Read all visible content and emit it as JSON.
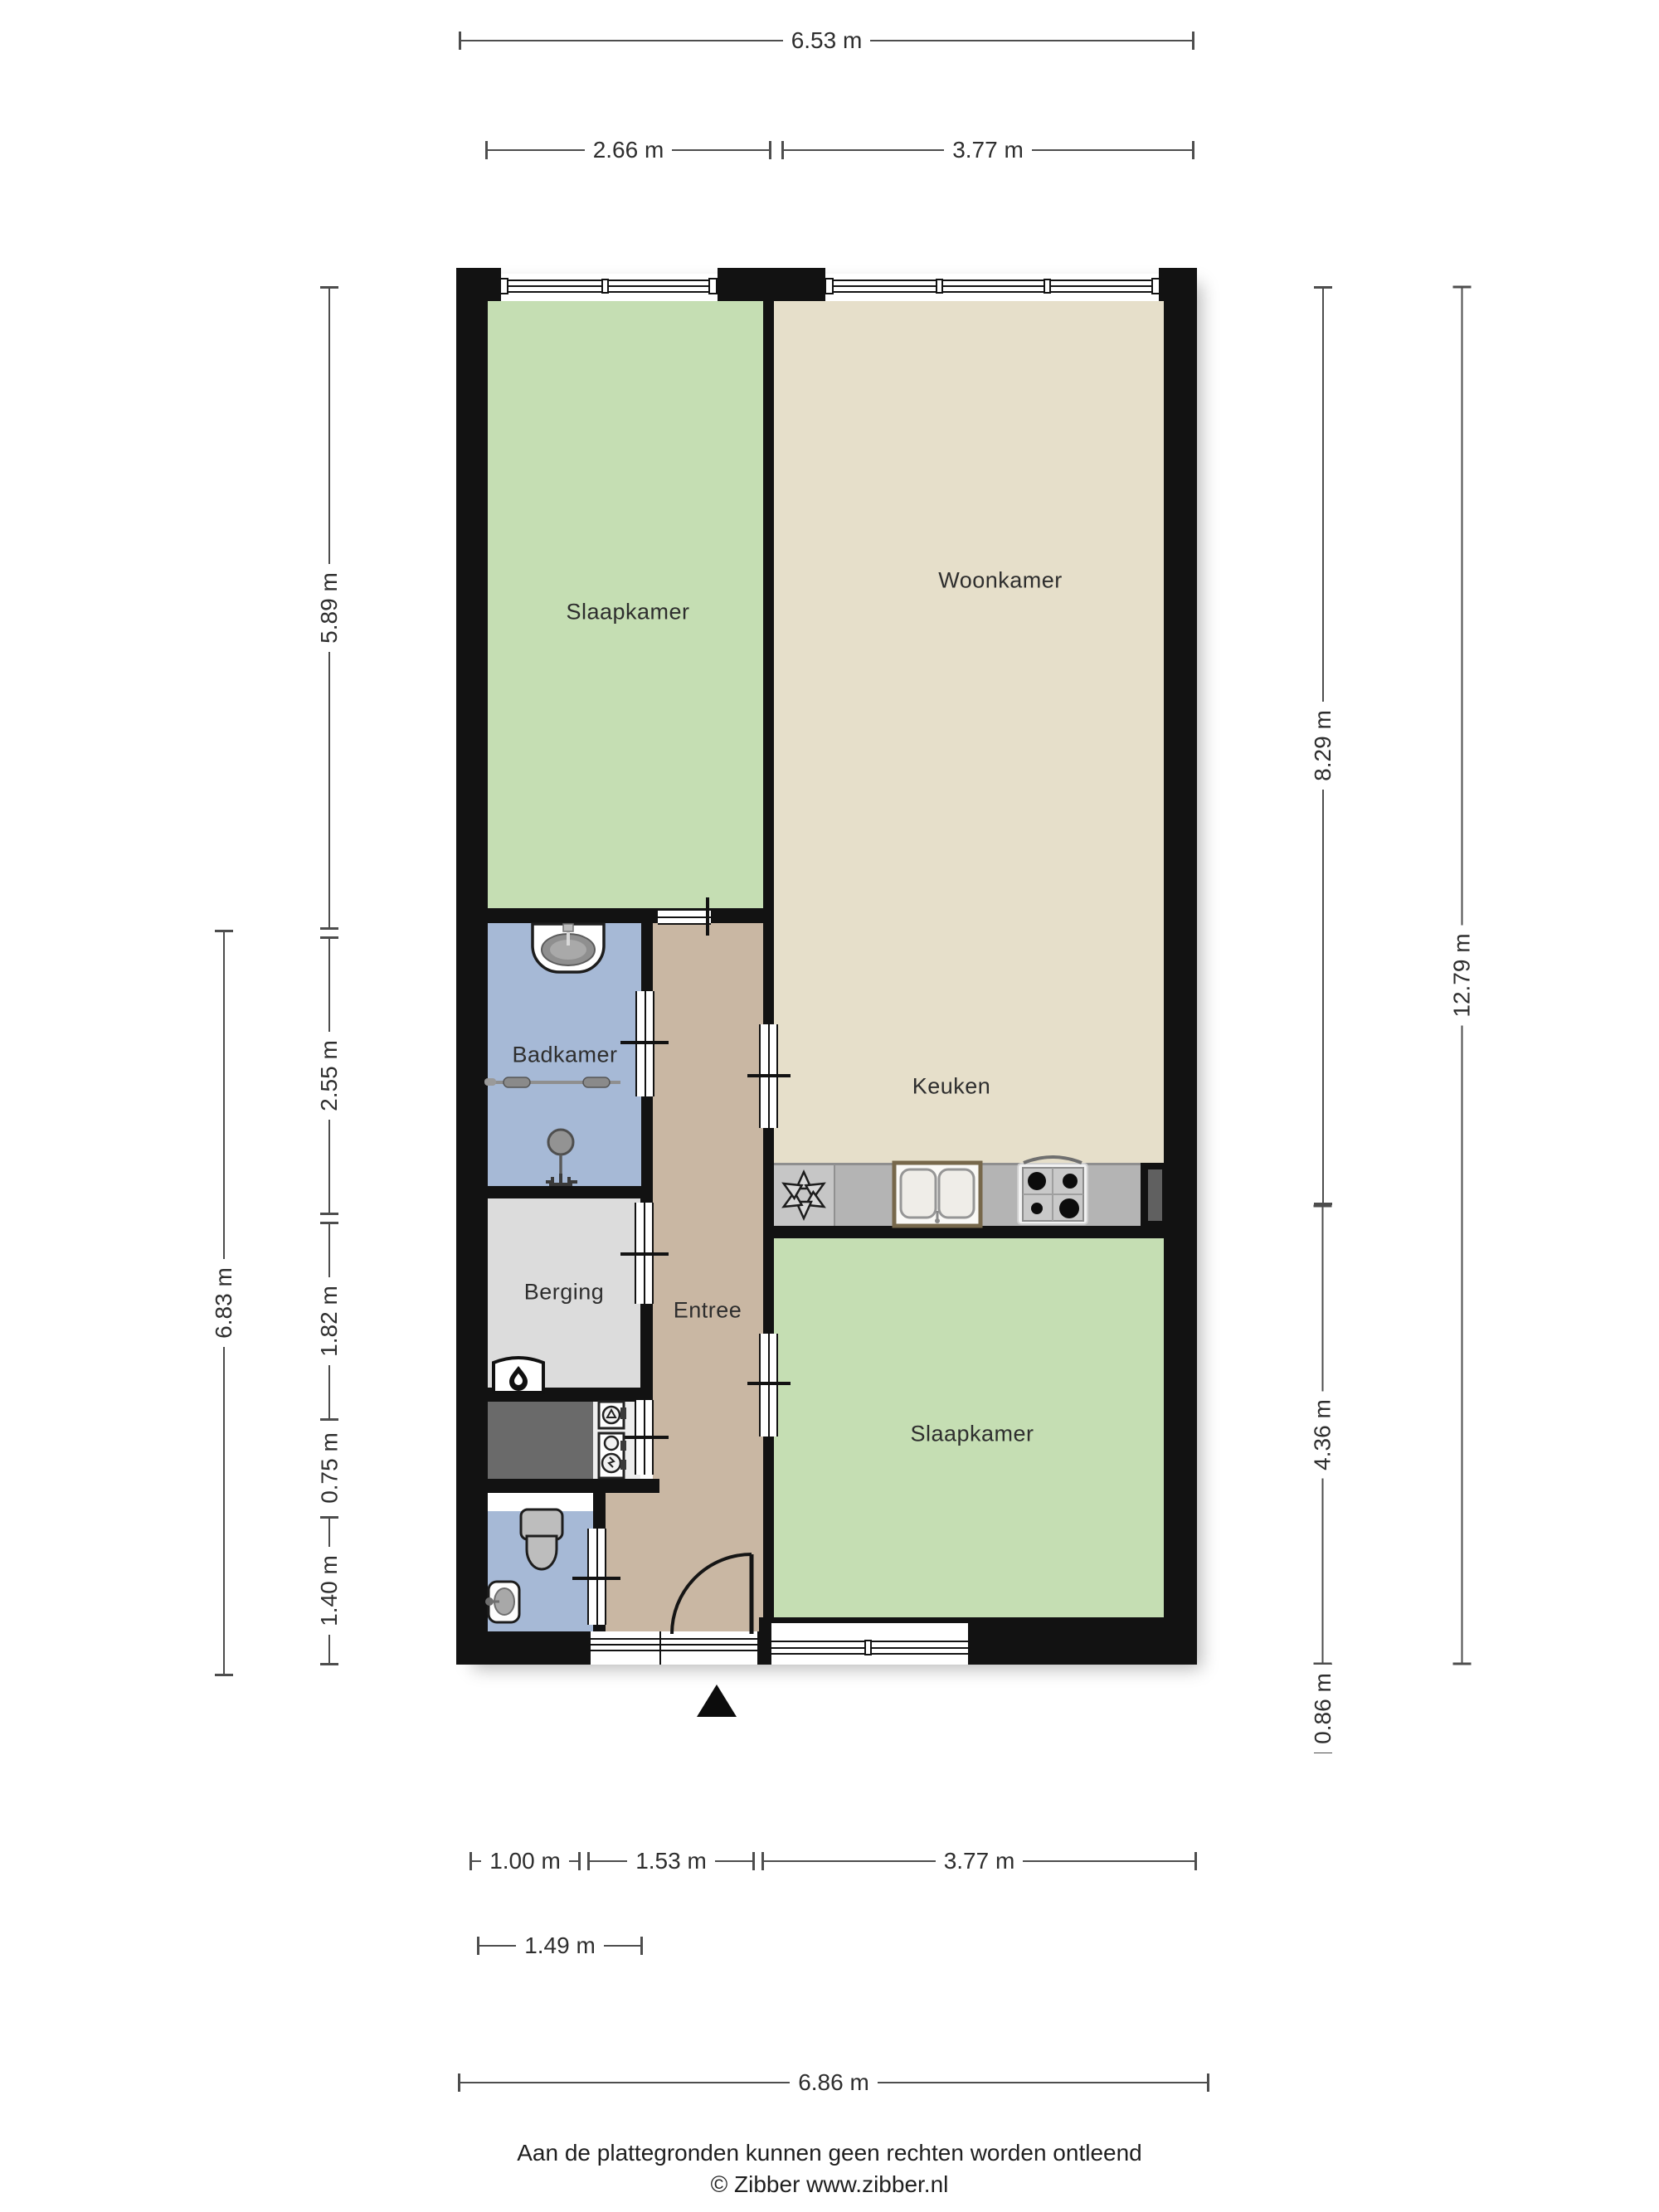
{
  "page": {
    "background": "#ffffff"
  },
  "plan": {
    "rooms": {
      "bedroom_top": "Slaapkamer",
      "living_room": "Woonkamer",
      "kitchen": "Keuken",
      "bathroom": "Badkamer",
      "storage": "Berging",
      "hall": "Entree",
      "bedroom_bottom": "Slaapkamer"
    }
  },
  "dimensions": {
    "top_total": "6.53 m",
    "top_left_section": "2.66 m",
    "top_right_section": "3.77 m",
    "left_bedroom": "5.89 m",
    "left_bathroom": "2.55 m",
    "left_storage": "1.82 m",
    "left_closet": "0.75 m",
    "left_toilet": "1.40 m",
    "left_lower_total": "6.83 m",
    "right_upper": "8.29 m",
    "right_lower": "4.36 m",
    "right_below_plan": "0.86 m",
    "right_total": "12.79 m",
    "bottom_left": "1.00 m",
    "bottom_hall": "1.53 m",
    "bottom_bedroom": "3.77 m",
    "bottom_entrance": "1.49 m",
    "bottom_total": "6.86 m"
  },
  "footer": {
    "disclaimer": "Aan de plattegronden kunnen geen rechten worden ontleend",
    "credit": "© Zibber www.zibber.nl"
  },
  "colors": {
    "wall": "#121212",
    "bedroom_green": "#c5deb3",
    "living_beige": "#e6dfca",
    "bath_blue": "#a6b9d6",
    "hall_tan": "#c9b7a3",
    "storage_gray": "#dcdcdc",
    "closet_dark": "#6a6a6a",
    "meter_gray": "#eeeeee",
    "counter_gray": "#b4b4b4",
    "counter_light": "#c6c6c6",
    "dim_line": "#4d4d4d",
    "text": "#2e2e2e"
  }
}
